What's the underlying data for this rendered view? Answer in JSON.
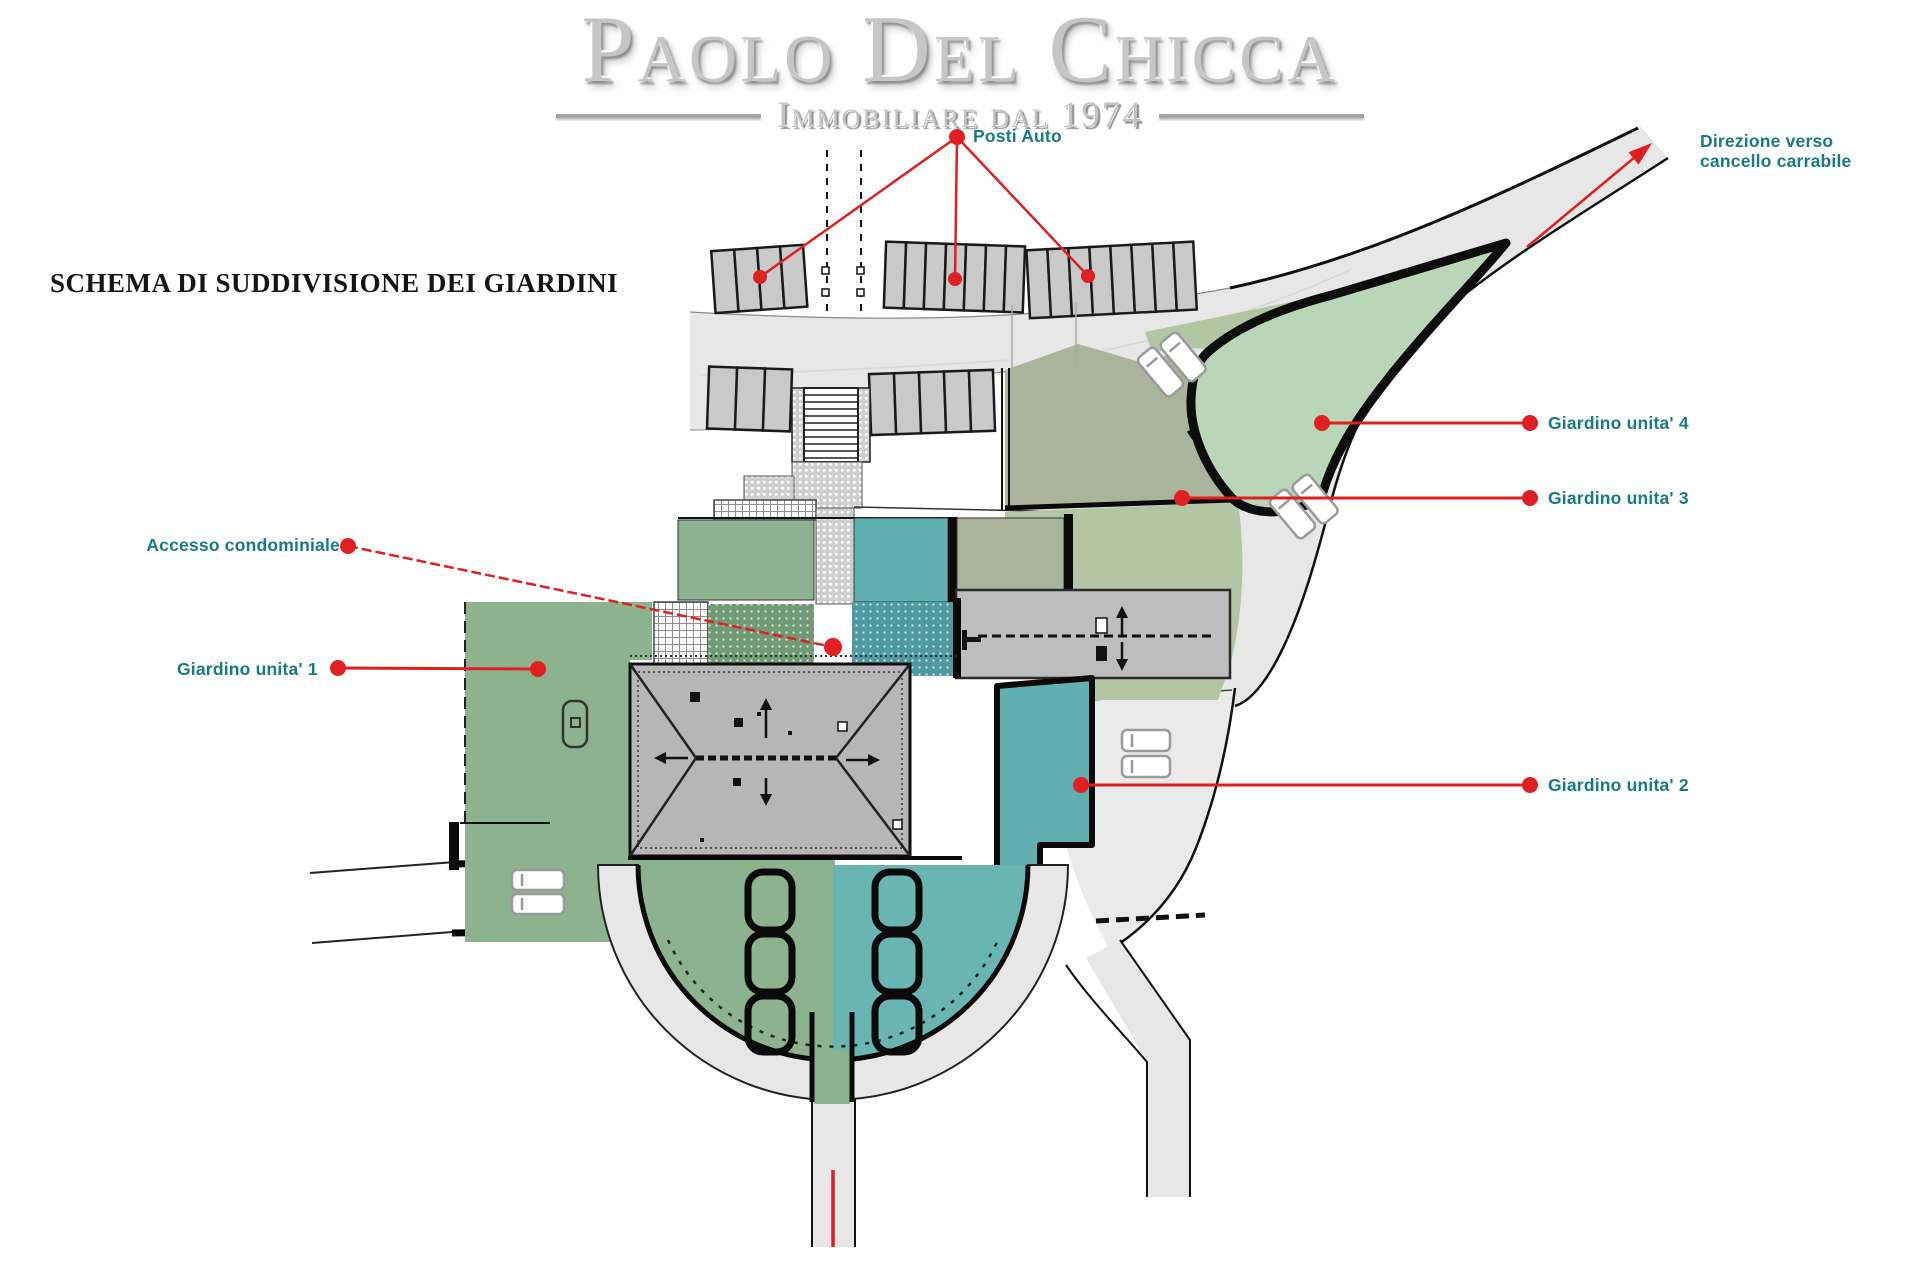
{
  "header": {
    "logo_title": "Paolo Del Chicca",
    "logo_subtitle": "Immobiliare dal 1974"
  },
  "title": "SCHEMA DI SUDDIVISIONE DEI GIARDINI",
  "plan_labels": {
    "posti_auto": "Posti Auto",
    "direzione_line1": "Direzione verso",
    "direzione_line2": "cancello carrabile",
    "accesso": "Accesso condominiale",
    "giardino1": "Giardino unita' 1",
    "giardino2": "Giardino unita' 2",
    "giardino3": "Giardino unita' 3",
    "giardino4": "Giardino unita' 4"
  },
  "colors": {
    "label_teal": "#177a85",
    "connector_red": "#e02020",
    "garden1_green": "#8cb38e",
    "garden2_teal": "#60b0b2",
    "garden3_olive": "#a9b49a",
    "garden4_light_green": "#b9d6b6",
    "middle_light_green": "#b2c6a3",
    "stipple_green": "#6f9a74",
    "stipple_teal": "#4f99a1",
    "road_gray": "#e7e7e7",
    "parking_gray": "#c9c9c9",
    "ramp_gray": "#bdbdbd",
    "roof_gray": "#b6b6b6",
    "logo_gray": "#c6c6c6"
  }
}
